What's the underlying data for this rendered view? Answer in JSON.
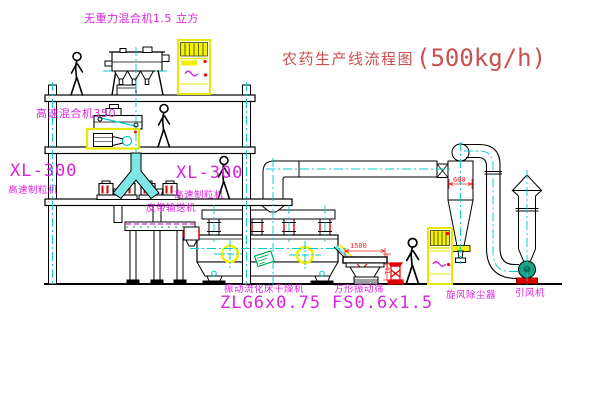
{
  "title": {
    "name": "农药生产线流程图",
    "capacity": "(500kg/h)"
  },
  "labels": {
    "gravity_mixer": "无重力混合机1.5 立方",
    "high_speed_mixer": "高速混合机350",
    "granulator_left_model": "XL-300",
    "granulator_left_name": "高速制粒机",
    "granulator_right_model": "XL-300",
    "granulator_right_name": "高速制粒机",
    "belt_conveyor": "皮带输送机",
    "dryer_name": "振动流化床干燥机",
    "dryer_model": "ZLG6x0.75",
    "screen_name": "方形振动筛",
    "screen_model": "FS0.6x1.5",
    "cyclone": "旋风除尘器",
    "induced_draft_fan": "引风机"
  },
  "dimensions": {
    "screen_length": "1500",
    "screen_height": "541",
    "cyclone_diameter": "600"
  },
  "colors": {
    "label_magenta": "#dd22dd",
    "title_red": "#cc4f4f",
    "dimension_red": "#ff2222",
    "centerline_cyan": "#00cccc",
    "pipe_fill_cyan": "#7fe6e6",
    "highlight_yellow": "#f2f200",
    "logo_green": "#00a651",
    "fan_teal": "#19a389",
    "line_black": "#000000",
    "background": "#ffffff"
  }
}
